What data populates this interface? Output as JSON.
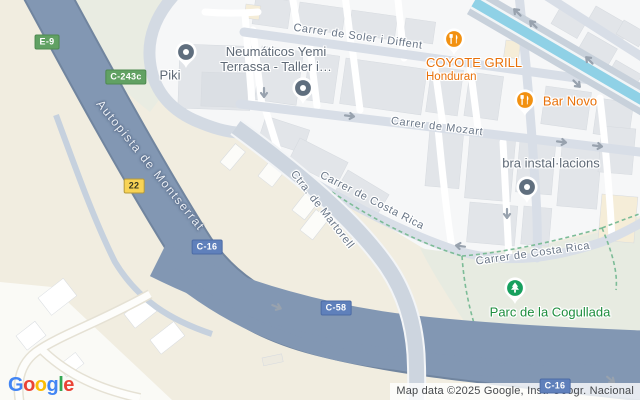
{
  "map": {
    "road_labels": [
      {
        "text": "Carrer de Soler i Diffent",
        "x": 358,
        "y": 37,
        "rot": 8,
        "cls": "street"
      },
      {
        "text": "Carrer de Mozart",
        "x": 437,
        "y": 127,
        "rot": 7,
        "cls": "street"
      },
      {
        "text": "Carrer de Costa Rica",
        "x": 372,
        "y": 201,
        "rot": 27,
        "cls": "street"
      },
      {
        "text": "Carrer de Costa Rica",
        "x": 533,
        "y": 254,
        "rot": -8,
        "cls": "street"
      },
      {
        "text": "Ctra. de Martorell",
        "x": 322,
        "y": 210,
        "rot": 52,
        "cls": "street"
      },
      {
        "text": "Autopista de Montserrat",
        "x": 150,
        "y": 166,
        "rot": 51,
        "cls": "highway"
      }
    ],
    "route_badges": [
      {
        "text": "E-9",
        "x": 47,
        "y": 42,
        "color": "green"
      },
      {
        "text": "C-243c",
        "x": 126,
        "y": 77,
        "color": "green"
      },
      {
        "text": "22",
        "x": 134,
        "y": 186,
        "color": "yellow"
      },
      {
        "text": "C-16",
        "x": 207,
        "y": 247,
        "color": "blue"
      },
      {
        "text": "C-58",
        "x": 336,
        "y": 308,
        "color": "blue"
      },
      {
        "text": "C-16",
        "x": 555,
        "y": 386,
        "color": "blue"
      }
    ],
    "poi_colors": {
      "generic": "#5F6E7E",
      "restaurant": "#F29111",
      "park": "#17A05E"
    },
    "pois": [
      {
        "id": "piki",
        "type": "generic",
        "name": "Piki",
        "pin": {
          "x": 186,
          "y": 52
        },
        "label": {
          "x": 170,
          "y": 76
        }
      },
      {
        "id": "neumaticos",
        "type": "generic",
        "name": "Neumáticos Yemi",
        "lines": [
          "Neumáticos Yemi",
          "Terrassa - Taller i…"
        ],
        "pin": {
          "x": 303,
          "y": 88
        },
        "label": {
          "x": 276,
          "y": 60
        }
      },
      {
        "id": "coyote-grill",
        "type": "restaurant",
        "name": "COYOTE GRILL",
        "sub": "Honduran",
        "align": "left",
        "pin": {
          "x": 454,
          "y": 39
        },
        "label": {
          "x": 426,
          "y": 70
        }
      },
      {
        "id": "bar-novo",
        "type": "restaurant",
        "name": "Bar Novo",
        "pin": {
          "x": 525,
          "y": 100
        },
        "label": {
          "x": 570,
          "y": 102
        }
      },
      {
        "id": "bra-installacions",
        "type": "generic",
        "name": "bra instal·lacions",
        "pin": {
          "x": 527,
          "y": 187
        },
        "label": {
          "x": 551,
          "y": 164
        }
      },
      {
        "id": "parc-cogullada",
        "type": "park",
        "name": "Parc de la Cogullada",
        "pin": {
          "x": 515,
          "y": 288
        },
        "label": {
          "x": 550,
          "y": 313
        }
      }
    ],
    "arrows": [
      {
        "x": 264,
        "y": 93,
        "a": 90
      },
      {
        "x": 350,
        "y": 116,
        "a": 7
      },
      {
        "x": 507,
        "y": 214,
        "a": 90
      },
      {
        "x": 562,
        "y": 142,
        "a": 7
      },
      {
        "x": 598,
        "y": 146,
        "a": 7
      },
      {
        "x": 517,
        "y": 12,
        "a": -135
      },
      {
        "x": 533,
        "y": 24,
        "a": -135
      },
      {
        "x": 589,
        "y": 60,
        "a": -135
      },
      {
        "x": 577,
        "y": 84,
        "a": 45
      },
      {
        "x": 277,
        "y": 307,
        "a": 22
      },
      {
        "x": 460,
        "y": 246,
        "a": 188
      },
      {
        "x": 611,
        "y": 380,
        "a": 40
      }
    ],
    "colors": {
      "terrain_beige": "#F1EDE0",
      "city": "#F6F7F8",
      "park": "#E7EBE1",
      "highway": "#8297B3",
      "avenue": "#D8DEE7",
      "channel_water": "#8FD1E6",
      "path_green": "#7CBC97",
      "arrow_grey": "#98A2AE"
    }
  },
  "logo": {
    "letters": [
      {
        "ch": "G",
        "color": "#4285F4"
      },
      {
        "ch": "o",
        "color": "#EA4335"
      },
      {
        "ch": "o",
        "color": "#FBBC05"
      },
      {
        "ch": "g",
        "color": "#4285F4"
      },
      {
        "ch": "l",
        "color": "#34A853"
      },
      {
        "ch": "e",
        "color": "#EA4335"
      }
    ]
  },
  "attribution": {
    "text": "Map data ©2025 Google, Inst. Geogr. Nacional"
  }
}
